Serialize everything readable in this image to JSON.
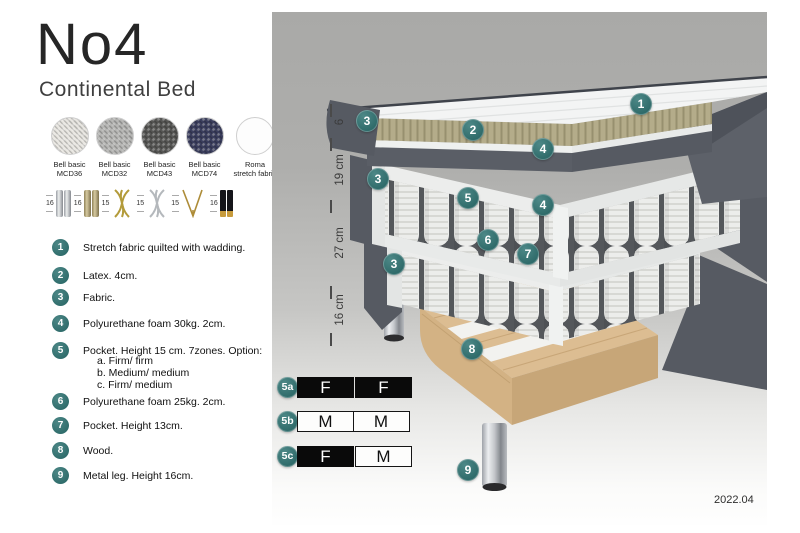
{
  "title": "No4",
  "subtitle": "Continental Bed",
  "fabrics": [
    {
      "name": "Bell basic",
      "code": "MCD36",
      "color": "#e9e7e2"
    },
    {
      "name": "Bell basic",
      "code": "MCD32",
      "color": "#b7b7b5"
    },
    {
      "name": "Bell basic",
      "code": "MCD43",
      "color": "#565654"
    },
    {
      "name": "Bell basic",
      "code": "MCD74",
      "color": "#3b3e5e"
    },
    {
      "name": "Roma",
      "code": "stretch fabric",
      "color": "#fdfdfd"
    }
  ],
  "leg_options": [
    {
      "height": "16",
      "type": "cylinder-chrome"
    },
    {
      "height": "16",
      "type": "cylinder-wood"
    },
    {
      "height": "15",
      "type": "twist-gold"
    },
    {
      "height": "15",
      "type": "twist-silver"
    },
    {
      "height": "15",
      "type": "hairpin-gold"
    },
    {
      "height": "16",
      "type": "cylinder-black-gold"
    }
  ],
  "spec_list": [
    {
      "num": "1",
      "text": "Stretch fabric quilted with wadding."
    },
    {
      "num": "2",
      "text": "Latex. 4cm."
    },
    {
      "num": "3",
      "text": "Fabric."
    },
    {
      "num": "4",
      "text": "Polyurethane foam 30kg. 2cm."
    },
    {
      "num": "5",
      "text": "Pocket. Height 15 cm. 7zones. Option:",
      "options": [
        "a. Firm/ firm",
        "b. Medium/ medium",
        "c. Firm/ medium"
      ]
    },
    {
      "num": "6",
      "text": "Polyurethane foam 25kg. 2cm."
    },
    {
      "num": "7",
      "text": "Pocket. Height 13cm."
    },
    {
      "num": "8",
      "text": "Wood."
    },
    {
      "num": "9",
      "text": "Metal leg. Height 16cm."
    }
  ],
  "dimensions": [
    {
      "label": "6"
    },
    {
      "label": "19 cm"
    },
    {
      "label": "27 cm"
    },
    {
      "label": "16 cm"
    }
  ],
  "callouts": {
    "n1": "1",
    "n2": "2",
    "n3": "3",
    "n4": "4",
    "n5": "5",
    "n6": "6",
    "n7": "7",
    "n8": "8",
    "n9": "9"
  },
  "firmness": {
    "rows": [
      {
        "label": "5a",
        "cells": [
          {
            "text": "F",
            "variant": "dark"
          },
          {
            "text": "F",
            "variant": "dark"
          }
        ]
      },
      {
        "label": "5b",
        "cells": [
          {
            "text": "M",
            "variant": "light"
          },
          {
            "text": "M",
            "variant": "light"
          }
        ]
      },
      {
        "label": "5c",
        "cells": [
          {
            "text": "F",
            "variant": "dark"
          },
          {
            "text": "M",
            "variant": "light"
          }
        ]
      }
    ]
  },
  "version": "2022.04",
  "colors": {
    "accent_teal": "#35706f",
    "bed_fabric_gray": "#575b63",
    "latex": "#b4ac8a",
    "wood": "#dcbd92"
  }
}
